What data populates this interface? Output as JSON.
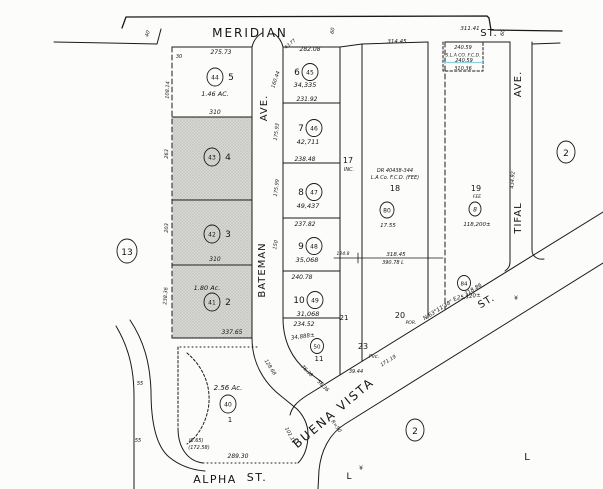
{
  "streets": {
    "meridian": "MERIDIAN",
    "meridian_st": "ST.",
    "bateman_ave": "AVE.",
    "bateman": "BATEMAN",
    "tifal": "TIFAL",
    "tifal_ave": "AVE.",
    "alpha": "ALPHA",
    "alpha_st": "ST.",
    "buena_vista": "BUENA VISTA",
    "buena_vista_st": "ST."
  },
  "refs": {
    "sheet_left": "13",
    "sheet_right": "2",
    "sheet_bottom": "2",
    "letter_a": "L",
    "letter_b": "L"
  },
  "lots": {
    "l1": {
      "num": "1",
      "circ": "40",
      "area": "2.56 Ac."
    },
    "l2": {
      "num": "2",
      "circ": "41",
      "area": "1.80 Ac."
    },
    "l3": {
      "num": "3",
      "circ": "42"
    },
    "l4": {
      "num": "4",
      "circ": "43"
    },
    "l5": {
      "num": "5",
      "circ": "44",
      "area": "1.46 AC."
    },
    "l6": {
      "num": "6",
      "circ": "45",
      "area": "34,335"
    },
    "l7": {
      "num": "7",
      "circ": "46",
      "area": "42,711"
    },
    "l8": {
      "num": "8",
      "circ": "47",
      "area": "49,437"
    },
    "l9": {
      "num": "9",
      "circ": "48",
      "area": "35,068"
    },
    "l10": {
      "num": "10",
      "circ": "49",
      "area": "31,068"
    },
    "l11": {
      "num": "11",
      "circ": "50",
      "area": "34,888±"
    },
    "l17": {
      "num": "17",
      "sub": "INC."
    },
    "l18": {
      "num": "18",
      "circ": "80",
      "area": "17.55",
      "line1": "DR 40438-344",
      "line2": "L.A Co. F.C.D. (FEE)"
    },
    "l19": {
      "num": "19",
      "circ": "8",
      "area": "118,200±",
      "sub": "FEE"
    },
    "l20": {
      "num": "20",
      "sub": "POR.",
      "circ": "84",
      "area": "25,120±"
    },
    "l21": {
      "num": "21"
    },
    "l23": {
      "num": "23",
      "sub": "Pvc."
    }
  },
  "fcd": {
    "dim_top": "240.59",
    "name": "S.L.A CO. F.C.D.",
    "dim_mid": "240.59",
    "dim_bottom": "310.36"
  },
  "dims": {
    "d27573": "275.73",
    "d310a": "310",
    "d310b": "310",
    "d33765": "337.65",
    "d10814": "108.14",
    "d263": "263",
    "d203": "203",
    "d23836": "238.36",
    "d28208": "282.08",
    "d23192": "231.92",
    "d23848": "238.48",
    "d23782": "237.82",
    "d24078": "240.78",
    "d23452": "234.52",
    "d16044": "160.44",
    "d17593": "175.93",
    "d17599": "175.99",
    "d150": "150",
    "d4377": "43.77",
    "d31445": "314.45",
    "d31141": "311.41",
    "d43492": "434.92",
    "d31845": "318.45",
    "d39078": "390.78 L",
    "d1248": "124.8",
    "bearing": "N 63°11'38\" E",
    "d31886": "318.86",
    "d17119": "171.19",
    "d3944": "39.44",
    "d12868": "128.68",
    "d7638": "76.38",
    "d5636": "56.36",
    "d10111": "101.11",
    "r50": "R=50",
    "d28930": "289.30",
    "d665": "(6.65)",
    "d17258": "(172.58)",
    "w40": "40",
    "w30": "30",
    "w55a": "55",
    "w55b": "55",
    "w60a": "60",
    "w60b": "60",
    "sym_a": "¥",
    "sym_b": "¥"
  }
}
